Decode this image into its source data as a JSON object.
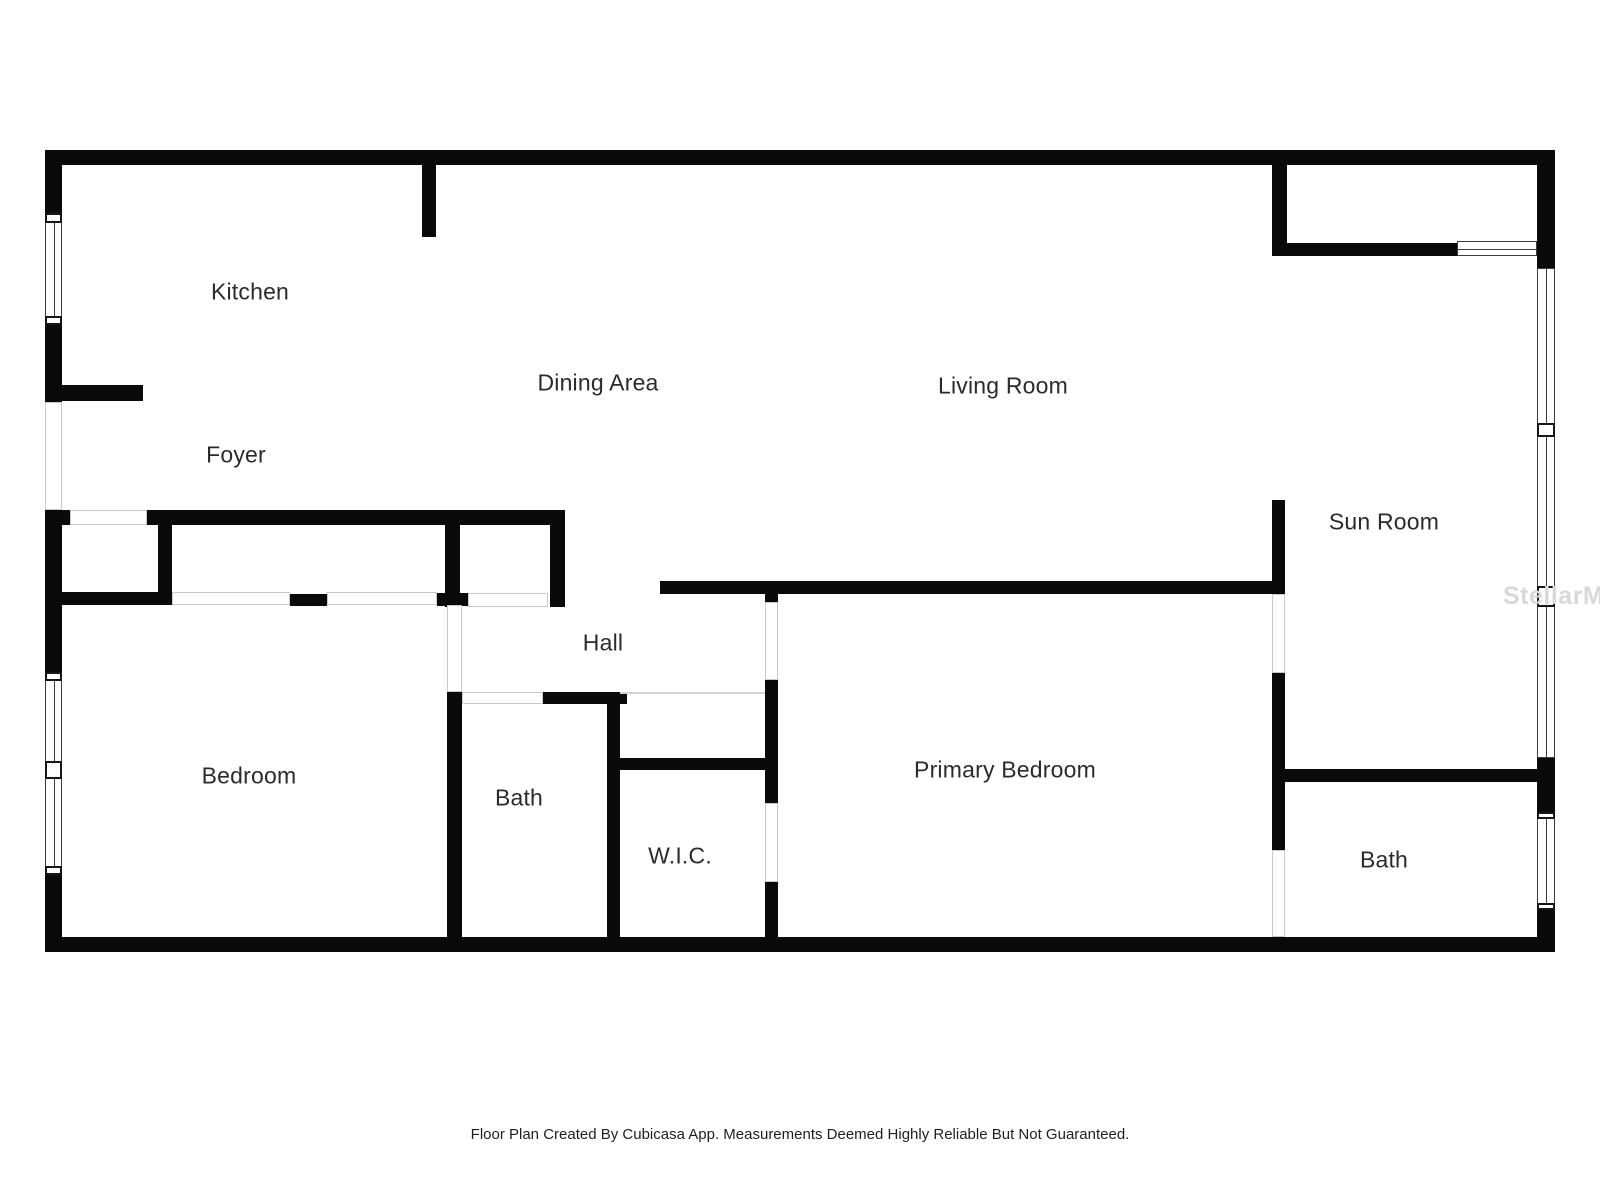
{
  "watermark": {
    "text": "StellarMLS",
    "color": "#d8d8d8"
  },
  "footer": {
    "text": "Floor Plan Created By Cubicasa App. Measurements Deemed Highly Reliable But Not Guaranteed."
  },
  "palette": {
    "wall": "#0a0a0a",
    "opening_line": "#c9c9c9",
    "window_line": "#3c3c3c",
    "label": "#2b2b2b"
  },
  "rooms": [
    {
      "id": "kitchen",
      "label": "Kitchen",
      "x": 250,
      "y": 292
    },
    {
      "id": "foyer",
      "label": "Foyer",
      "x": 236,
      "y": 455
    },
    {
      "id": "dining-area",
      "label": "Dining Area",
      "x": 598,
      "y": 383
    },
    {
      "id": "living-room",
      "label": "Living Room",
      "x": 1003,
      "y": 386
    },
    {
      "id": "sun-room",
      "label": "Sun Room",
      "x": 1384,
      "y": 522
    },
    {
      "id": "hall",
      "label": "Hall",
      "x": 603,
      "y": 643
    },
    {
      "id": "bedroom",
      "label": "Bedroom",
      "x": 249,
      "y": 776
    },
    {
      "id": "bath",
      "label": "Bath",
      "x": 519,
      "y": 798
    },
    {
      "id": "wic",
      "label": "W.I.C.",
      "x": 680,
      "y": 856
    },
    {
      "id": "primary-bedroom",
      "label": "Primary Bedroom",
      "x": 1005,
      "y": 770
    },
    {
      "id": "bath-2",
      "label": "Bath",
      "x": 1384,
      "y": 860
    }
  ],
  "plan": {
    "elements": [
      {
        "kind": "wall",
        "name": "wall-perimeter-top",
        "x": 45,
        "y": 150,
        "w": 1510,
        "h": 15
      },
      {
        "kind": "wall",
        "name": "wall-perimeter-bottom",
        "x": 45,
        "y": 937,
        "w": 1510,
        "h": 15
      },
      {
        "kind": "wall",
        "name": "wall-left-1",
        "x": 45,
        "y": 150,
        "w": 17,
        "h": 63
      },
      {
        "kind": "wall",
        "name": "wall-left-2",
        "x": 45,
        "y": 325,
        "w": 17,
        "h": 77
      },
      {
        "kind": "wall",
        "name": "wall-left-3",
        "x": 45,
        "y": 510,
        "w": 17,
        "h": 162
      },
      {
        "kind": "wall",
        "name": "wall-left-4",
        "x": 45,
        "y": 875,
        "w": 17,
        "h": 77
      },
      {
        "kind": "wall",
        "name": "wall-right-1",
        "x": 1537,
        "y": 150,
        "w": 18,
        "h": 118
      },
      {
        "kind": "wall",
        "name": "wall-right-2",
        "x": 1537,
        "y": 758,
        "w": 18,
        "h": 54
      },
      {
        "kind": "wall",
        "name": "wall-right-3",
        "x": 1537,
        "y": 910,
        "w": 18,
        "h": 42
      },
      {
        "kind": "wall",
        "name": "wall-kitchen-stub",
        "x": 422,
        "y": 165,
        "w": 14,
        "h": 72
      },
      {
        "kind": "wall",
        "name": "wall-foyer-stub",
        "x": 45,
        "y": 385,
        "w": 98,
        "h": 16
      },
      {
        "kind": "wall",
        "name": "wall-closet-top",
        "x": 147,
        "y": 510,
        "w": 418,
        "h": 15
      },
      {
        "kind": "wall",
        "name": "wall-closet-top-left-stub",
        "x": 45,
        "y": 510,
        "w": 25,
        "h": 15
      },
      {
        "kind": "wall",
        "name": "wall-bedroom-top",
        "x": 45,
        "y": 592,
        "w": 132,
        "h": 13
      },
      {
        "kind": "wall",
        "name": "wall-closet-divider-left",
        "x": 158,
        "y": 510,
        "w": 14,
        "h": 95
      },
      {
        "kind": "wall",
        "name": "wall-closet-post",
        "x": 290,
        "y": 594,
        "w": 37,
        "h": 12
      },
      {
        "kind": "wall",
        "name": "wall-closet-divider-mid",
        "x": 445,
        "y": 510,
        "w": 15,
        "h": 97
      },
      {
        "kind": "wall",
        "name": "wall-closet-mid-foot",
        "x": 437,
        "y": 593,
        "w": 33,
        "h": 13
      },
      {
        "kind": "wall",
        "name": "wall-closet-right",
        "x": 550,
        "y": 510,
        "w": 15,
        "h": 97
      },
      {
        "kind": "wall",
        "name": "wall-bath-west",
        "x": 447,
        "y": 692,
        "w": 15,
        "h": 260
      },
      {
        "kind": "wall",
        "name": "wall-bath-top",
        "x": 543,
        "y": 692,
        "w": 84,
        "h": 12
      },
      {
        "kind": "wall",
        "name": "wall-bath-east",
        "x": 607,
        "y": 692,
        "w": 13,
        "h": 260
      },
      {
        "kind": "wall",
        "name": "wall-wic-top",
        "x": 607,
        "y": 758,
        "w": 170,
        "h": 12
      },
      {
        "kind": "wall",
        "name": "wall-wic-east-upper",
        "x": 765,
        "y": 680,
        "w": 13,
        "h": 123
      },
      {
        "kind": "wall",
        "name": "wall-wic-east-lower",
        "x": 765,
        "y": 882,
        "w": 13,
        "h": 70
      },
      {
        "kind": "wall",
        "name": "wall-primary-door-jamb",
        "x": 765,
        "y": 593,
        "w": 13,
        "h": 9
      },
      {
        "kind": "wall",
        "name": "wall-primary-top",
        "x": 660,
        "y": 581,
        "w": 625,
        "h": 13
      },
      {
        "kind": "wall",
        "name": "wall-sunroom-west-upper",
        "x": 1272,
        "y": 500,
        "w": 13,
        "h": 94
      },
      {
        "kind": "wall",
        "name": "wall-sunroom-west-lower",
        "x": 1272,
        "y": 673,
        "w": 13,
        "h": 177
      },
      {
        "kind": "wall",
        "name": "wall-bath2-top",
        "x": 1285,
        "y": 769,
        "w": 255,
        "h": 13
      },
      {
        "kind": "wall",
        "name": "wall-topright-west",
        "x": 1272,
        "y": 165,
        "w": 15,
        "h": 91
      },
      {
        "kind": "wall",
        "name": "wall-topright-bottom",
        "x": 1272,
        "y": 243,
        "w": 185,
        "h": 13
      },
      {
        "kind": "window-v",
        "name": "window-left-upper",
        "x": 45,
        "y": 213,
        "w": 17,
        "h": 112
      },
      {
        "kind": "window-v",
        "name": "window-left-lower",
        "x": 45,
        "y": 672,
        "w": 17,
        "h": 203
      },
      {
        "kind": "window-v",
        "name": "window-right-upper",
        "x": 1537,
        "y": 268,
        "w": 18,
        "h": 490
      },
      {
        "kind": "window-v",
        "name": "window-right-lower",
        "x": 1537,
        "y": 812,
        "w": 18,
        "h": 98
      },
      {
        "kind": "window-h",
        "name": "window-topright",
        "x": 1457,
        "y": 241,
        "w": 80,
        "h": 15
      },
      {
        "kind": "mullion",
        "name": "window-mullion",
        "x": 45,
        "y": 213,
        "w": 17,
        "h": 10
      },
      {
        "kind": "mullion",
        "name": "window-mullion",
        "x": 45,
        "y": 316,
        "w": 17,
        "h": 9
      },
      {
        "kind": "mullion",
        "name": "window-mullion",
        "x": 45,
        "y": 672,
        "w": 17,
        "h": 9
      },
      {
        "kind": "mullion",
        "name": "window-mullion",
        "x": 45,
        "y": 761,
        "w": 17,
        "h": 18
      },
      {
        "kind": "mullion",
        "name": "window-mullion",
        "x": 45,
        "y": 866,
        "w": 17,
        "h": 9
      },
      {
        "kind": "mullion",
        "name": "window-mullion",
        "x": 1537,
        "y": 423,
        "w": 18,
        "h": 14
      },
      {
        "kind": "mullion",
        "name": "window-mullion",
        "x": 1537,
        "y": 586,
        "w": 18,
        "h": 21
      },
      {
        "kind": "mullion",
        "name": "window-mullion",
        "x": 1537,
        "y": 812,
        "w": 18,
        "h": 7
      },
      {
        "kind": "mullion",
        "name": "window-mullion",
        "x": 1537,
        "y": 903,
        "w": 18,
        "h": 7
      },
      {
        "kind": "opening",
        "name": "opening-front-door",
        "x": 45,
        "y": 402,
        "w": 17,
        "h": 108
      },
      {
        "kind": "opening",
        "name": "opening-foyer-closet-door",
        "x": 70,
        "y": 510,
        "w": 77,
        "h": 15
      },
      {
        "kind": "opening",
        "name": "opening-closet1-slide-l",
        "x": 172,
        "y": 592,
        "w": 118,
        "h": 13
      },
      {
        "kind": "opening",
        "name": "opening-closet1-slide-r",
        "x": 327,
        "y": 592,
        "w": 110,
        "h": 13
      },
      {
        "kind": "opening",
        "name": "opening-closet2-slide",
        "x": 468,
        "y": 593,
        "w": 80,
        "h": 14
      },
      {
        "kind": "opening",
        "name": "opening-bedroom-door",
        "x": 447,
        "y": 605,
        "w": 15,
        "h": 87
      },
      {
        "kind": "opening",
        "name": "opening-bath-door",
        "x": 462,
        "y": 692,
        "w": 81,
        "h": 12
      },
      {
        "kind": "opening",
        "name": "opening-primary-door",
        "x": 765,
        "y": 602,
        "w": 13,
        "h": 78
      },
      {
        "kind": "opening",
        "name": "opening-wic-door",
        "x": 765,
        "y": 803,
        "w": 13,
        "h": 79
      },
      {
        "kind": "opening",
        "name": "opening-sunroom-door",
        "x": 1272,
        "y": 594,
        "w": 13,
        "h": 79
      },
      {
        "kind": "opening",
        "name": "opening-bath2-door",
        "x": 1272,
        "y": 850,
        "w": 13,
        "h": 87
      },
      {
        "kind": "hairline",
        "name": "hall-south-line",
        "x": 620,
        "y": 692,
        "w": 145,
        "h": 2
      }
    ]
  }
}
